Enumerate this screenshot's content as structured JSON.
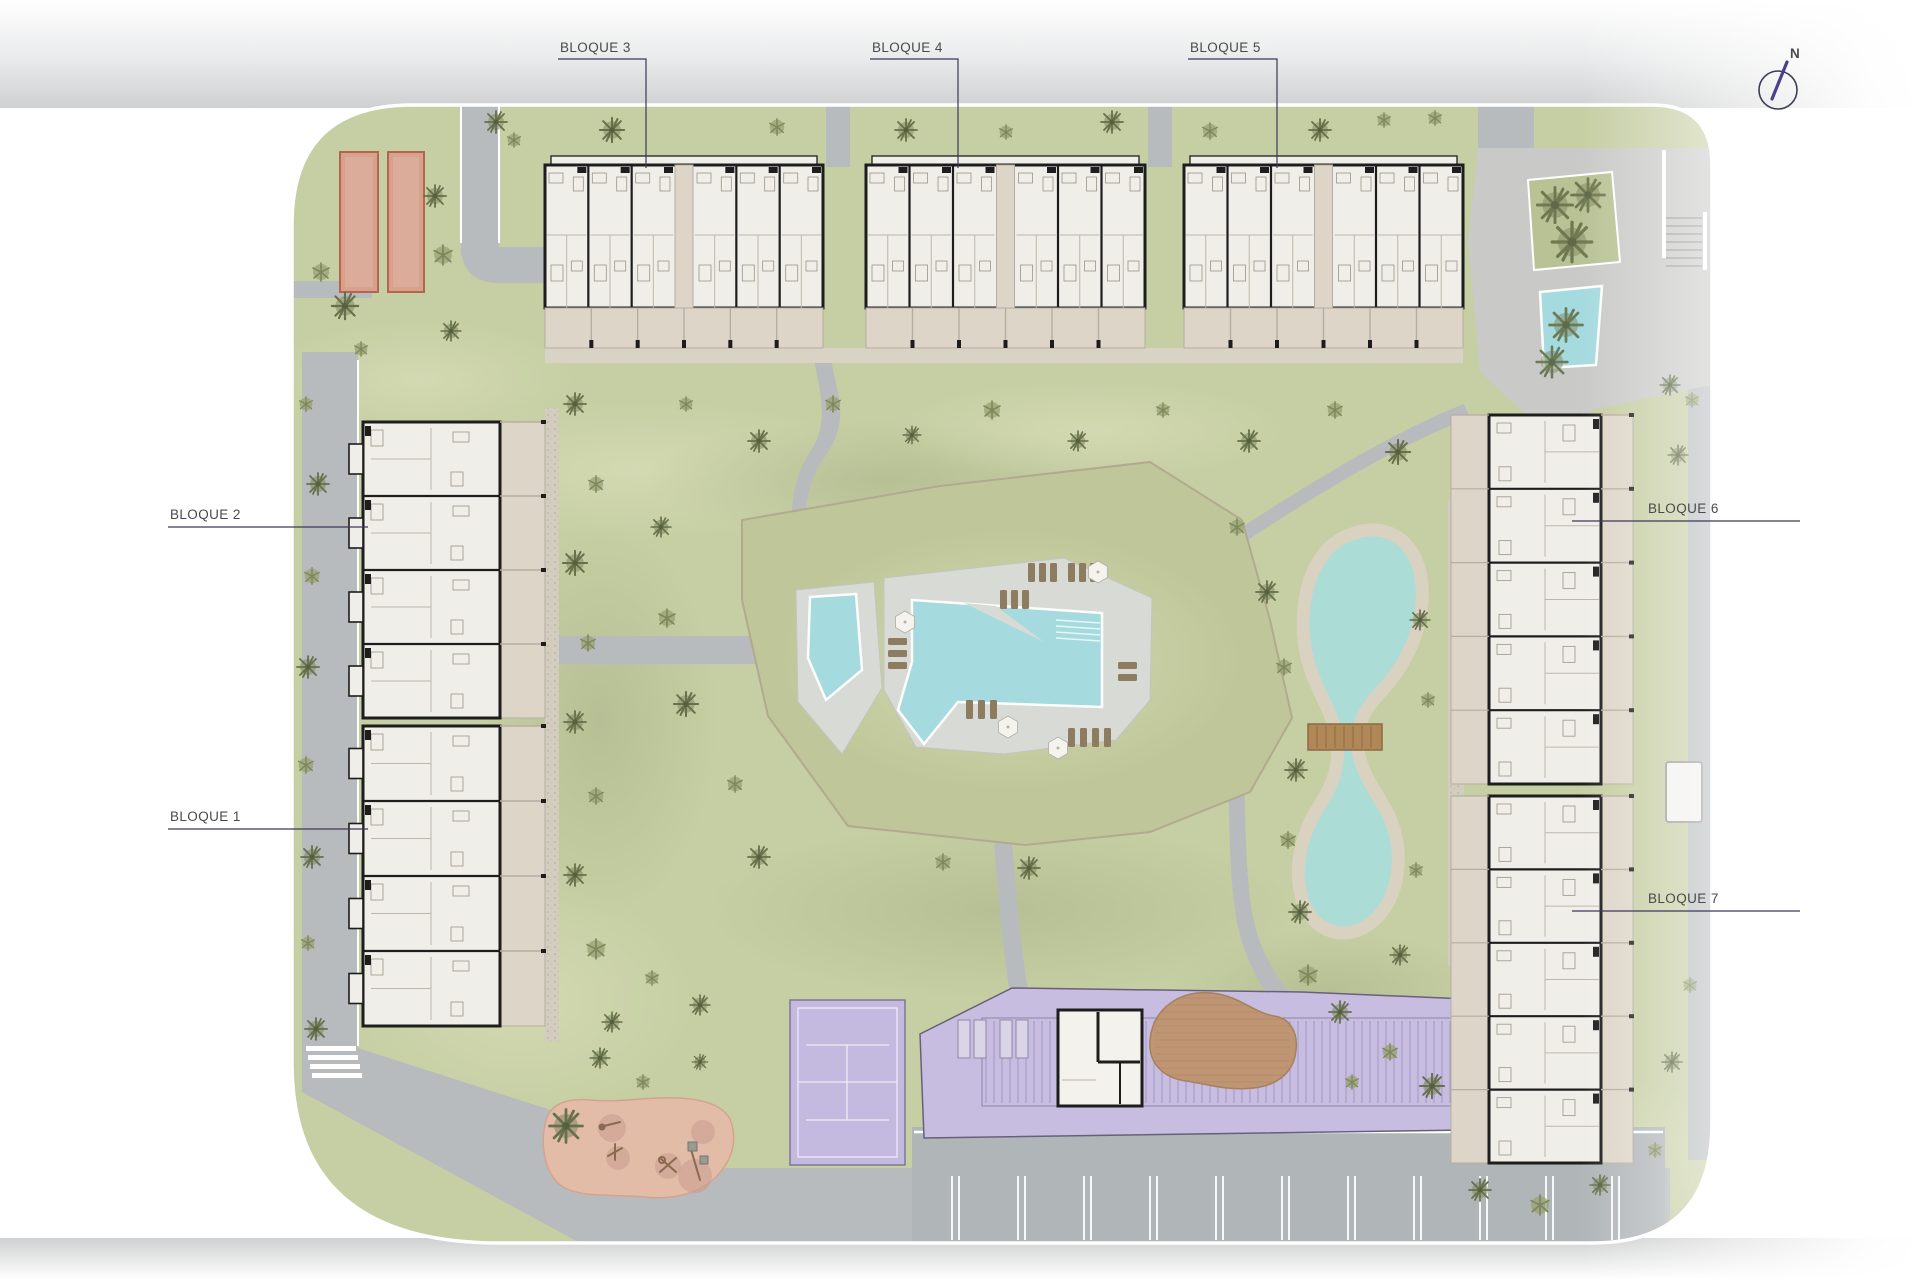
{
  "page": {
    "background": "#ffffff",
    "description": "residential development site plan"
  },
  "north_indicator": {
    "label": "N"
  },
  "block_labels": [
    {
      "id": "bloque-1",
      "label": "BLOQUE 1"
    },
    {
      "id": "bloque-2",
      "label": "BLOQUE 2"
    },
    {
      "id": "bloque-3",
      "label": "BLOQUE 3"
    },
    {
      "id": "bloque-4",
      "label": "BLOQUE 4"
    },
    {
      "id": "bloque-5",
      "label": "BLOQUE 5"
    },
    {
      "id": "bloque-6",
      "label": "BLOQUE 6"
    },
    {
      "id": "bloque-7",
      "label": "BLOQUE 7"
    }
  ],
  "colors": {
    "grass": "#c6cea3",
    "grass_light": "#d6dcb6",
    "grass_dark": "#aeb88d",
    "mound": "#bfc79a",
    "road": "#b7bbbd",
    "road2": "#b0b5b8",
    "plaza": "#c9cac8",
    "walk": "#d9d3c6",
    "gravel": "#d2cdbf",
    "building_fill": "#f0eee8",
    "building_wall": "#1d1d1d",
    "terrace": "#ddd6c8",
    "furniture": "#a39e92",
    "pool_deck": "#d8dad6",
    "pool_water": "#a5dade",
    "lake_water": "#abdcd6",
    "lake_shore": "#d9d2c0",
    "lounger": "#8d7c60",
    "umbrella": "#f5f3ee",
    "court": "#c4badf",
    "pergola_zone": "#c7bde0",
    "pergola_stripe": "#a89cc7",
    "deck_wood": "#bf9573",
    "playground": "#e3bca8",
    "playground_spot": "#c99b90",
    "petanque": "#d8a18c",
    "petanque_border": "#b4654d",
    "bridge": "#b08756",
    "label_text": "#4a4a4a",
    "leader_line": "#3e3757",
    "north": "#4b3f8f"
  }
}
